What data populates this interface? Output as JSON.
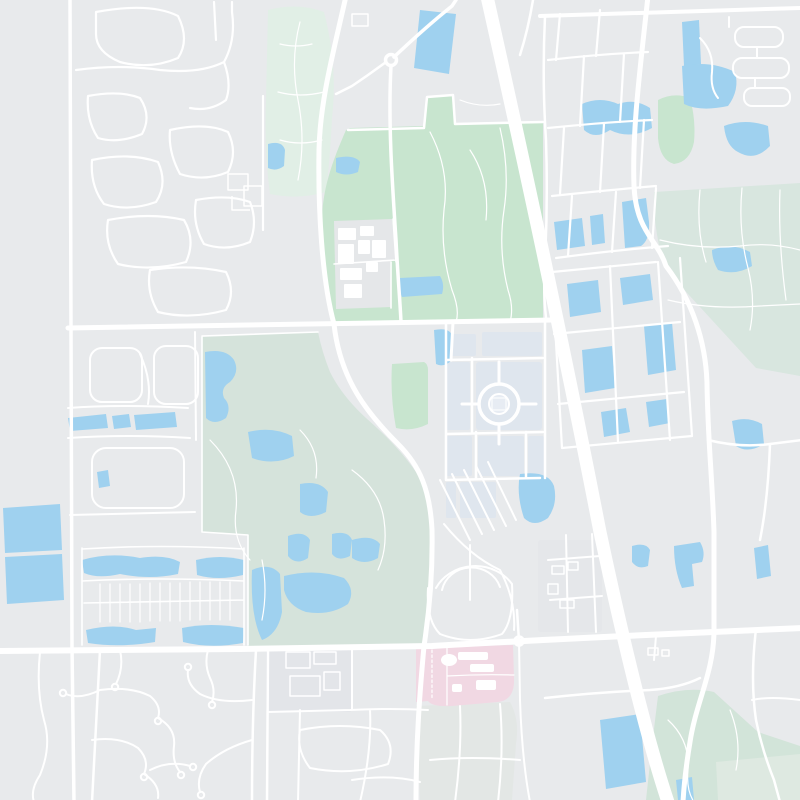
{
  "app": {
    "type": "map-viewer",
    "view": "unlabeled light street-map tile, suburban area with highway, parks, golf courses, lakes and campuses",
    "labels_visible": false,
    "zoom_controls_visible": false
  },
  "map": {
    "features": [
      {
        "name": "highway",
        "kind": "road-motorway",
        "color_ref": "road"
      },
      {
        "name": "arterial-roads",
        "kind": "road-major",
        "color_ref": "road"
      },
      {
        "name": "residential-streets",
        "kind": "road-minor",
        "color_ref": "road"
      },
      {
        "name": "central-park",
        "kind": "park",
        "color_ref": "park"
      },
      {
        "name": "golf-course-northeast",
        "kind": "golf",
        "color_ref": "golf"
      },
      {
        "name": "golf-course-centerleft",
        "kind": "golf",
        "color_ref": "golf2"
      },
      {
        "name": "greenbelt-southeast",
        "kind": "greenspace",
        "color_ref": "green_muted"
      },
      {
        "name": "school-campus",
        "kind": "campus",
        "color_ref": "campus"
      },
      {
        "name": "shopping-center",
        "kind": "commercial",
        "color_ref": "commercial"
      },
      {
        "name": "hospital-campus",
        "kind": "hospital",
        "color_ref": "hospital"
      },
      {
        "name": "lakes-and-ponds",
        "kind": "water",
        "color_ref": "water"
      },
      {
        "name": "cul-de-sac-neighborhood",
        "kind": "road-minor",
        "color_ref": "road"
      }
    ]
  },
  "colors": {
    "background": "#e8eaec",
    "road": "#ffffff",
    "water": "#9fd1ef",
    "park": "#c8e5cf",
    "park_tint": "#e1efe6",
    "golf": "#d8e6df",
    "golf2": "#d5e3db",
    "green_muted": "#d2e4d9",
    "green_muted_light": "#dee9e1",
    "tint2": "#e3e7e5",
    "campus": "#e5e7e9",
    "commercial": "#dfe6ee",
    "commercial2": "#e3e5e9",
    "hospital": "#f1d8e3",
    "building": "#ffffff"
  }
}
